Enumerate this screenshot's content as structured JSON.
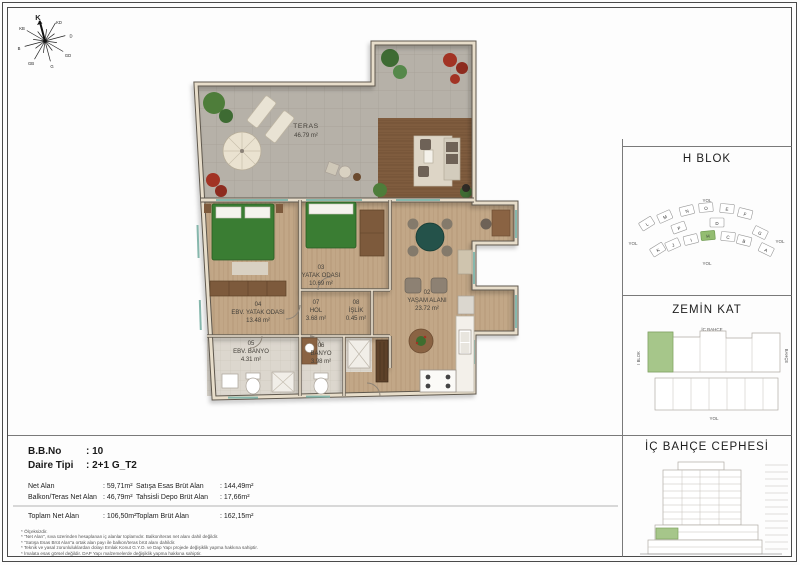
{
  "compass": {
    "labels": [
      "K",
      "KD",
      "D",
      "GD",
      "G",
      "GB",
      "B",
      "KB"
    ]
  },
  "plan": {
    "terrace": {
      "name": "TERAS",
      "area": "46.79 m²"
    },
    "rooms": [
      {
        "num": "02",
        "name": "YAŞAM ALANI",
        "area": "23.72 m²"
      },
      {
        "num": "03",
        "name": "YATAK ODASI",
        "area": "10.69 m²"
      },
      {
        "num": "04",
        "name": "EBV. YATAK ODASI",
        "area": "13.48 m²"
      },
      {
        "num": "05",
        "name": "EBV. BANYO",
        "area": "4.31 m²"
      },
      {
        "num": "06",
        "name": "BANYO",
        "area": "3.98 m²"
      },
      {
        "num": "07",
        "name": "HOL",
        "area": "3.68 m²"
      },
      {
        "num": "08",
        "name": "İŞLİK",
        "area": "0.45 m²"
      }
    ]
  },
  "panels": {
    "block": {
      "title": "H BLOK",
      "road": "YOL",
      "highlight_color": "#93bd71",
      "blocks": [
        {
          "letter": "L"
        },
        {
          "letter": "M"
        },
        {
          "letter": "N"
        },
        {
          "letter": "O"
        },
        {
          "letter": "E"
        },
        {
          "letter": "F"
        },
        {
          "letter": "G"
        },
        {
          "letter": "K"
        },
        {
          "letter": "J"
        },
        {
          "letter": "I"
        },
        {
          "letter": "H"
        },
        {
          "letter": "C"
        },
        {
          "letter": "B"
        },
        {
          "letter": "A"
        },
        {
          "letter": "P"
        },
        {
          "letter": "D"
        }
      ]
    },
    "floor": {
      "title": "ZEMİN KAT",
      "top": "İÇ BAHÇE",
      "left": "I BLOK",
      "right": "BAHÇE",
      "bottom": "YOL",
      "highlight_color": "#a6c68a"
    },
    "elevation": {
      "title": "İÇ BAHÇE CEPHESİ",
      "highlight_color": "#a6c68a"
    }
  },
  "info": {
    "bb_no": {
      "label": "B.B.No",
      "value": ": 10"
    },
    "daire_tipi": {
      "label": "Daire Tipi",
      "value": ": 2+1 G_T2"
    },
    "areas": [
      {
        "label": "Net Alan",
        "value": ": 59,71m²"
      },
      {
        "label": "Balkon/Teras Net Alan",
        "value": ": 46,79m²"
      },
      {
        "label": "Satışa Esas Brüt Alan",
        "value": ": 144,49m²"
      },
      {
        "label": "Tahsisli Depo Brüt Alan",
        "value": ": 17,66m²"
      }
    ],
    "totals": [
      {
        "label": "Toplam Net Alan",
        "value": ": 106,50m²"
      },
      {
        "label": "Toplam Brüt Alan",
        "value": ": 162,15m²"
      }
    ],
    "footnotes": [
      "* Ölçeksizdir.",
      "* \"Net Alan\", sıva üzerinden hesaplanan iç alanlar toplamıdır. Balkon/teras net alanı dahil değildir.",
      "* \"Satışa Esas Brüt Alan\"a ortak alan payı ile balkon/teras brüt alanı dahildir.",
      "* Teknik ve yasal zorunluluklardan dolayı Emlak Konut G.Y.O. ve Dap Yapı projede değişiklik yapma hakkına sahiptir.",
      "* İmalata esas görsel değildir. DAP Yapı malzemelerde değişiklik yapma hakkına sahiptir."
    ]
  }
}
